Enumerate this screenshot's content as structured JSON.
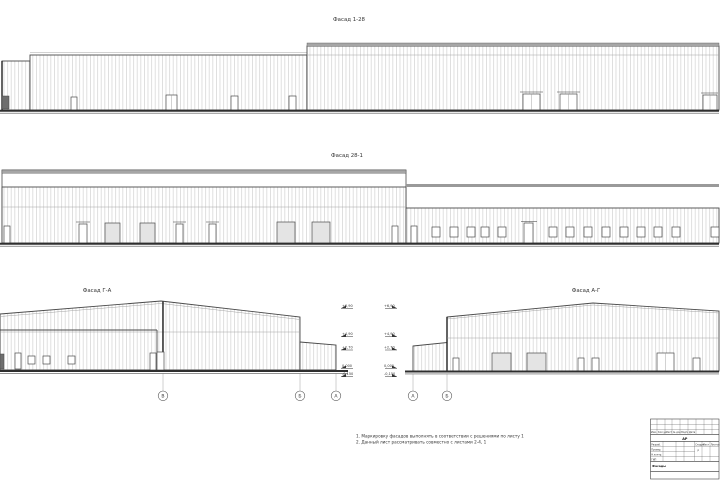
{
  "elevations": {
    "top": {
      "title": "Фасад 1-28"
    },
    "middle": {
      "title": "Фасад 28-1"
    },
    "bottom_left": {
      "title": "Фасад Г-А"
    },
    "bottom_right": {
      "title": "Фасад А-Г"
    }
  },
  "levels": {
    "left": [
      "+6,90",
      "+4,90",
      "+2,70",
      "0,000",
      "-0,150"
    ],
    "right": [
      "+6,90",
      "+4,90",
      "+2,70",
      "0,000",
      "-0,150"
    ]
  },
  "axes": {
    "left": [
      "В",
      "Б",
      "А"
    ],
    "right": [
      "А",
      "Б"
    ]
  },
  "notes": [
    "1. Маркировку фасадов выполнять в соответствии с решениями по листу 1",
    "2. Данный лист рассматривать совместно с листами 2-4, 1"
  ],
  "title_block": {
    "header_cols": [
      "Изм.",
      "Кол.уч.",
      "Лист",
      "№ док.",
      "Подп.",
      "Дата"
    ],
    "code": "АР",
    "roles": [
      "Разраб.",
      "Провер.",
      "Н.контр.",
      "ГИП"
    ],
    "doc_title": "Фасады",
    "stage_cols": [
      "Стадия",
      "Лист",
      "Листов"
    ],
    "stage": "Р"
  },
  "colors": {
    "line": "#4a4a4a",
    "siding": "#c6c6c6",
    "cap": "#a6a6a6",
    "ground": "#2e2e2e",
    "rollup_fill": "#e4e4e4"
  }
}
